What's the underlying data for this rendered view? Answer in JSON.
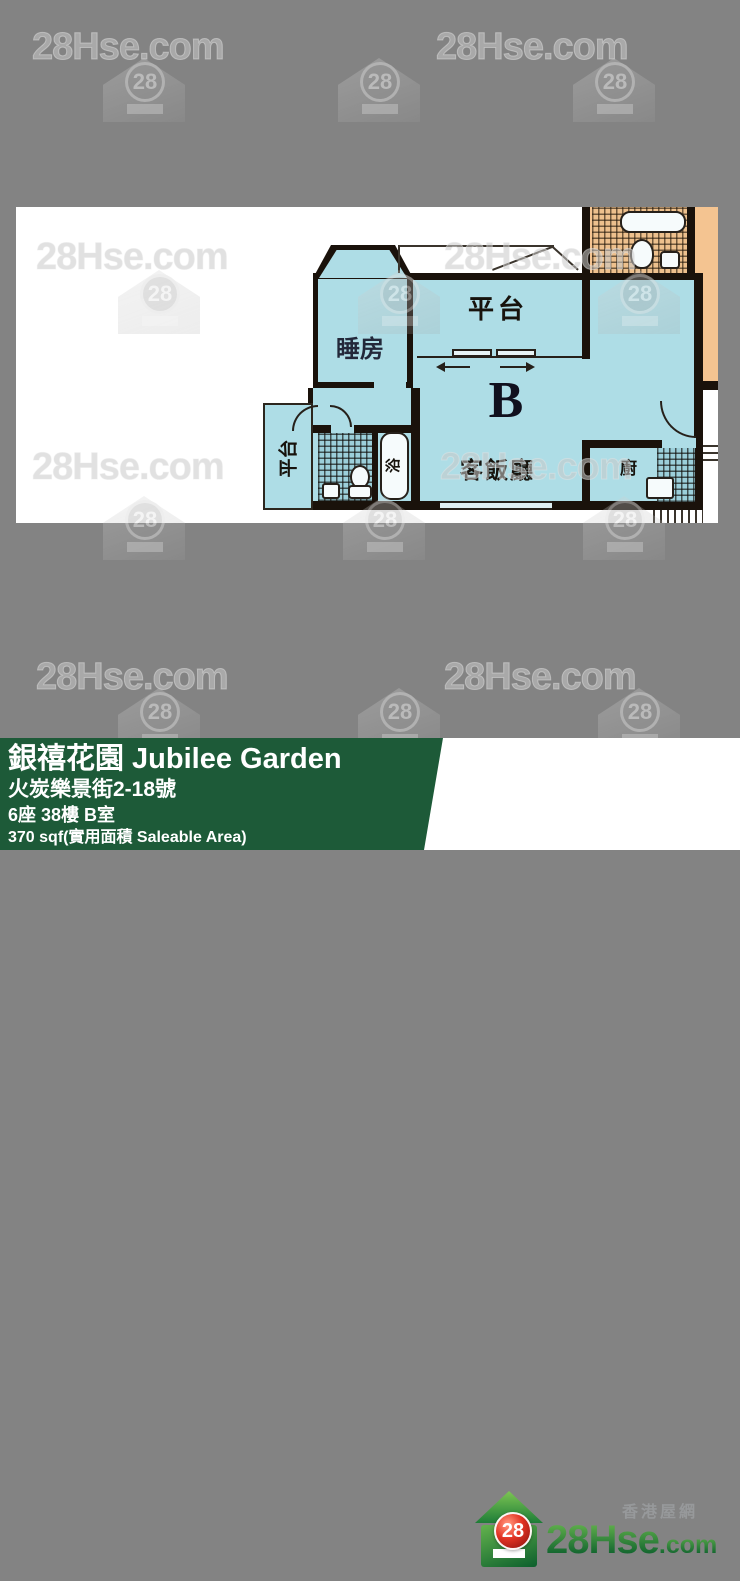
{
  "watermark": {
    "site": "28Hse.com",
    "logo_number": "28"
  },
  "floor_plan": {
    "unit_letter": "B",
    "labels": {
      "bedroom": "睡房",
      "terrace_top": "平台",
      "living_dining": "客飯廳",
      "terrace_left": "平台",
      "bath": "浴",
      "kitchen": "廚",
      "adjacent_bedroom": "BED RM."
    }
  },
  "info_bar": {
    "estate_name": "銀禧花園 Jubilee Garden",
    "address": "火炭樂景街2-18號",
    "unit": "6座 38樓 B室",
    "area": "370 sqf(實用面積 Saleable Area)"
  },
  "brand": {
    "tagline": "香港屋網",
    "logo_number": "28",
    "site_name": "28Hse",
    "site_tld": ".com"
  },
  "colors": {
    "background": "#838383",
    "unit_fill": "#AEDDE6",
    "adjacent_fill": "#F4C491",
    "wall": "#1A120B",
    "bar_green": "#1D5A38",
    "brand_green": "#147138",
    "brand_red": "#D6281C"
  }
}
